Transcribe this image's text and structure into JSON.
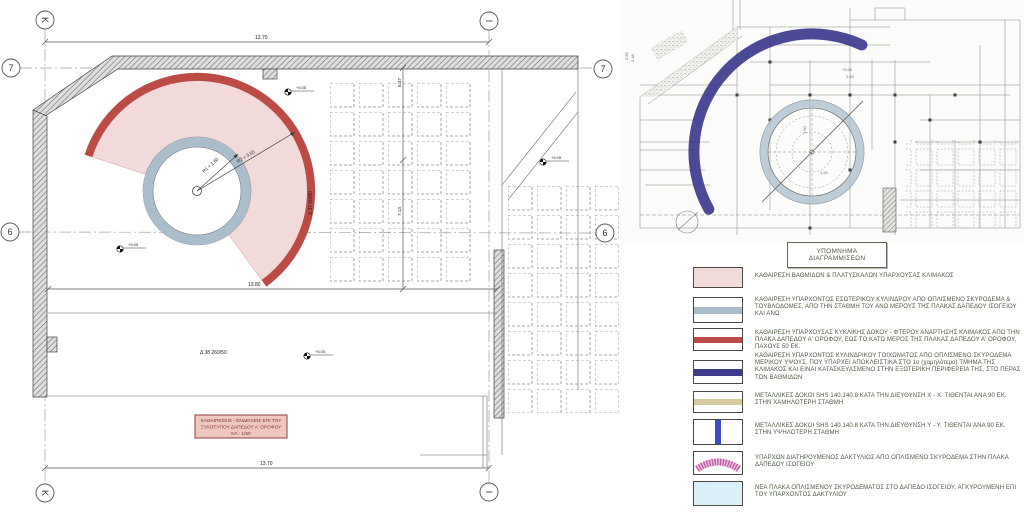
{
  "colors": {
    "pink_fill": "#f3dada",
    "red_band": "#bc4a45",
    "blue_gray": "#a9bdcb",
    "navy": "#3d3a8e",
    "tan": "#d6cb9e",
    "blue_beam": "#3f4bc6",
    "magenta": "#c45ca9",
    "cyan_fill": "#daf1fa",
    "legend_text": "#4e5a45",
    "title_fill": "#efc7bf",
    "title_stroke": "#8c3f35",
    "title_text": "#7c332b"
  },
  "left_drawing": {
    "grid": {
      "k": "K",
      "i": "Ι",
      "seven": "7",
      "six": "6"
    },
    "dims": {
      "top": "13.70",
      "mid": "13.80",
      "bottom": "13.70",
      "v_upper": "6.47",
      "v_lower": "7.13"
    },
    "radii": {
      "r1": "R1 = 1.60",
      "r2": "R2 = 3.55"
    },
    "beams": {
      "circular": "Δ 37  60/60",
      "bottom": "Δ 38  260/50"
    },
    "spot_elevation": "+5.05",
    "title_box": {
      "line1": "ΚΑΘΑΙΡΕΣΕΙΣ - ΕΝΔΕΙΞΕΙΣ ΕΠΙ ΤΟΥ",
      "line2": "ΞΥΛΟΤΥΠΟΥ ΔΑΠΕΔΟΥ Α' ΟΡΟΦΟΥ",
      "line3": "ΚΛ : 1/50"
    }
  },
  "right_drawing": {
    "annotations": {
      "a1": "+0.00",
      "a2": "1.40",
      "a3": "1.50",
      "a4": "1.20",
      "a5": "2.50",
      "a6": "2.44"
    }
  },
  "legend": {
    "header_line1": "ΥΠΟΜΝΗΜΑ",
    "header_line2": "ΔΙΑΓΡΑΜΜΙΣΕΩΝ",
    "items": [
      {
        "swatch": "pink-solid",
        "text": "ΚΑΘΑΙΡΕΣΗ ΒΑΘΜΙΔΩΝ & ΠΛΑΤΥΣΚΑΛΩΝ ΥΠΑΡΧΟΥΣΑΣ ΚΛΙΜΑΚΟΣ"
      },
      {
        "swatch": "bluegray-band",
        "text": "ΚΑΘΑΙΡΕΣΗ ΥΠΑΡΧΟΝΤΟΣ ΕΣΩΤΕΡΙΚΟΥ ΚΥΛΙΝΔΡΟΥ ΑΠΟ ΟΠΛΙΣΜΕΝΟ ΣΚΥΡΟΔΕΜΑ & ΤΟΥΒΛΟΔΟΜΕΣ, ΑΠΟ ΤΗΝ ΣΤΑΘΜΗ ΤΟΥ ΑΝΩ ΜΕΡΟΥΣ ΤΗΣ ΠΛΑΚΑΣ ΔΑΠΕΔΟΥ ΙΣΟΓΕΙΟΥ ΚΑΙ ΑΝΩ"
      },
      {
        "swatch": "red-band",
        "text": "ΚΑΘΑΙΡΕΣΗ ΥΠΑΡΧΟΥΣΑΣ ΚΥΚΛΙΚΗΣ ΔΟΚΟΥ - ΦΤΕΡΟΥ ΑΝΑΡΤΗΣΗΣ ΚΛΙΜΑΚΟΣ ΑΠΟ ΤΗΝ ΠΛΑΚΑ ΔΑΠΕΔΟΥ Α' ΟΡΟΦΟΥ, ΕΩΣ ΤΟ ΚΑΤΩ ΜΕΡΟΣ ΤΗΣ ΠΛΑΚΑΣ ΔΑΠΕΔΟΥ Α' ΟΡΟΦΟΥ, ΠΑΧΟΥΣ 50 ΕΚ."
      },
      {
        "swatch": "navy-band",
        "text": "ΚΑΘΑΙΡΕΣΗ ΥΠΑΡΧΟΝΤΟΣ ΚΥΛΙΝΔΡΙΚΟΥ ΤΟΙΧΩΜΑΤΟΣ ΑΠΟ ΟΠΛΙΣΜΕΝΟ ΣΚΥΡΟΔΕΜΑ ΜΕΡΙΚΟΥ ΥΨΟΥΣ, ΠΟΥ ΥΠΑΡΧΕΙ ΑΠΟΚΛΕΙΣΤΙΚΑ ΣΤΟ 1ο (χαμηλότερο) ΤΜΗΜΑ ΤΗΣ ΚΛΙΜΑΚΟΣ ΚΑΙ ΕΙΝΑΙ ΚΑΤΑΣΚΕΥΑΣΜΕΝΟ ΣΤΗΝ ΕΞΩΤΕΡΙΚΗ ΠΕΡΙΦΕΡΕΙΑ ΤΗΣ, ΣΤΟ ΠΕΡΑΣ ΤΩΝ ΒΑΘΜΙΔΩΝ"
      },
      {
        "swatch": "tan-band",
        "text": "ΜΕΤΑΛΛΙΚΕΣ ΔΟΚΟΙ SHS 140.140.8 ΚΑΤΑ ΤΗΝ ΔΙΕΥΘΥΝΣΗ X - X. ΤΙΘΕΝΤΑΙ ΑΝΑ 90 ΕΚ. ΣΤΗΝ ΧΑΜΗΛΟΤΕΡΗ ΣΤΑΘΜΗ"
      },
      {
        "swatch": "blue-vband",
        "text": "ΜΕΤΑΛΛΙΚΕΣ ΔΟΚΟΙ SHS 140.140.8 ΚΑΤΑ ΤΗΝ ΔΙΕΥΘΥΝΣΗ Y - Y. ΤΙΘΕΝΤΑΙ ΑΝΑ 90 ΕΚ. ΣΤΗΝ ΥΨΗΛΟΤΕΡΗ ΣΤΑΘΜΗ"
      },
      {
        "swatch": "magenta-arc",
        "text": "ΥΠΑΡΧΩΝ ΔΙΑΤΗΡΟΥΜΕΝΟΣ ΔΑΚΤΥΛΙΟΣ ΑΠΟ ΟΠΛΙΣΜΕΝΟ ΣΚΥΡΟΔΕΜΑ ΣΤΗΝ ΠΛΑΚΑ  ΔΑΠΕΔΟΥ ΙΣΟΓΕΙΟΥ"
      },
      {
        "swatch": "cyan-solid",
        "text": "ΝΕΑ ΠΛΑΚΑ ΟΠΛΙΣΜΕΝΟΥ ΣΚΥΡΟΔΕΜΑΤΟΣ ΣΤΟ ΔΑΠΕΔΟ ΙΣΟΓΕΙΟΥ, ΑΓΚΥΡΟΥΜΕΝΗ ΕΠΙ ΤΟΥ ΥΠΑΡΧΟΝΤΟΣ ΔΑΚΤΥΛΙΟΥ"
      }
    ]
  }
}
